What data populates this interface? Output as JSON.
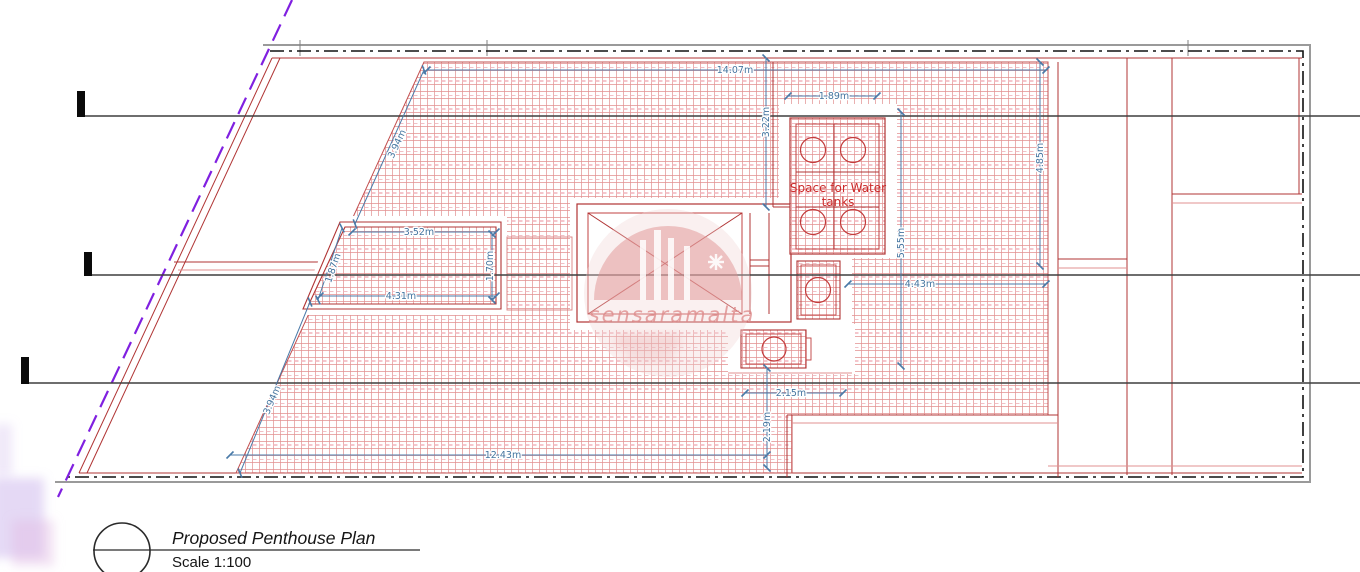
{
  "drawing": {
    "watermark_text": "sensaramalta",
    "water_tanks_line1": "Space for Water",
    "water_tanks_line2": "tanks"
  },
  "dimensions": {
    "roof_top_width": "14.07m",
    "tank_enclosure_width": "1.89m",
    "top_right_offset": "3.22m",
    "right_edge_height": "4.85m",
    "upper_slant_length": "3.94m",
    "room_top_width": "3.52m",
    "room_slant_side": "1.87m",
    "room_right_height": "1.70m",
    "room_bottom_width": "4.31m",
    "tank_zone_height": "5.55m",
    "east_terrace_width": "4.43m",
    "lower_recess_width": "2.15m",
    "lower_recess_height": "2.19m",
    "terrace_bottom_width": "12.43m",
    "lower_slant_length": "3.94m"
  },
  "title_block": {
    "title": "Proposed Penthouse Plan",
    "scale": "Scale 1:100"
  },
  "colors": {
    "hatch_red": "#d96c6c",
    "wall_red": "#b03434",
    "dimension_blue": "#4a7aa8",
    "section_black": "#3f3f3f",
    "boundary_purple": "#8020e0",
    "watermark_pink": "#de8a8a",
    "tank_label_red": "#cc2a2a"
  }
}
